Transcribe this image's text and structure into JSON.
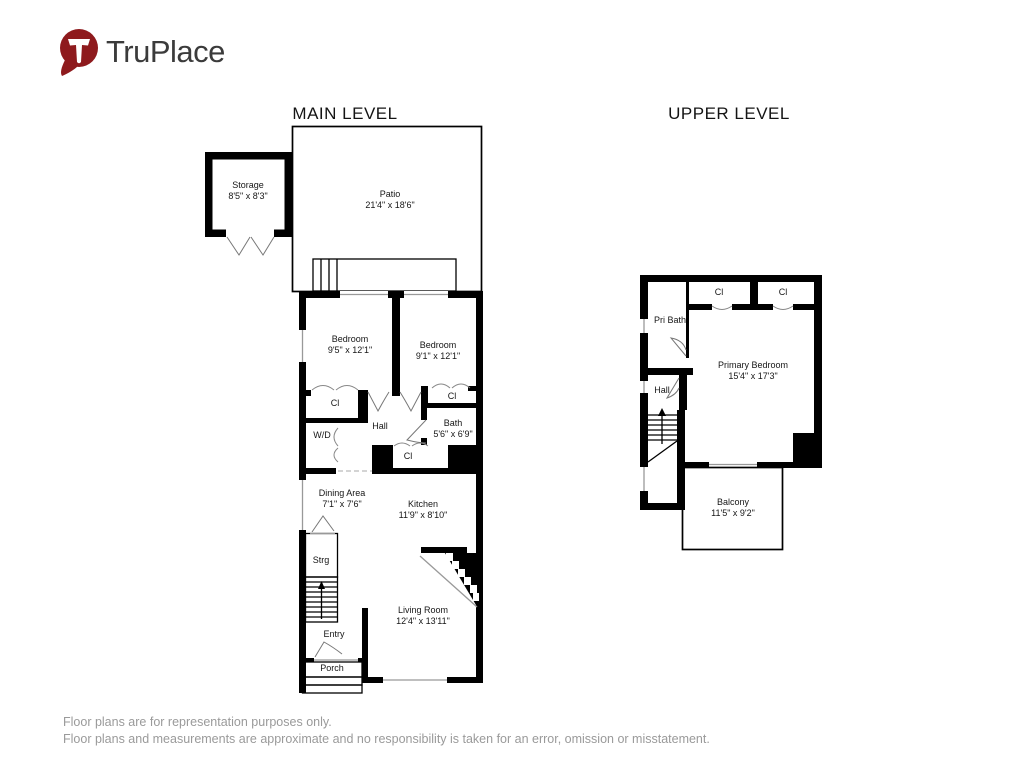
{
  "logo": {
    "brand": "TruPlace"
  },
  "titles": {
    "main": "MAIN LEVEL",
    "upper": "UPPER LEVEL"
  },
  "main_level": {
    "storage": {
      "name": "Storage",
      "dims": "8'5\" x 8'3\""
    },
    "patio": {
      "name": "Patio",
      "dims": "21'4\" x 18'6\""
    },
    "bedroom_left": {
      "name": "Bedroom",
      "dims": "9'5\" x 12'1\""
    },
    "bedroom_right": {
      "name": "Bedroom",
      "dims": "9'1\" x 12'1\""
    },
    "closet_left": {
      "name": "Cl"
    },
    "closet_right": {
      "name": "Cl"
    },
    "closet_hall": {
      "name": "Cl"
    },
    "washer_dryer": {
      "name": "W/D"
    },
    "hall": {
      "name": "Hall"
    },
    "bath": {
      "name": "Bath",
      "dims": "5'6\" x 6'9\""
    },
    "dining": {
      "name": "Dining Area",
      "dims": "7'1\" x 7'6\""
    },
    "kitchen": {
      "name": "Kitchen",
      "dims": "11'9\" x 8'10\""
    },
    "strg": {
      "name": "Strg"
    },
    "entry": {
      "name": "Entry"
    },
    "living": {
      "name": "Living Room",
      "dims": "12'4\" x 13'11\""
    },
    "porch": {
      "name": "Porch"
    }
  },
  "upper_level": {
    "pri_bath": {
      "name": "Pri Bath"
    },
    "closet_left": {
      "name": "Cl"
    },
    "closet_right": {
      "name": "Cl"
    },
    "primary_bedroom": {
      "name": "Primary Bedroom",
      "dims": "15'4\" x 17'3\""
    },
    "hall": {
      "name": "Hall"
    },
    "balcony": {
      "name": "Balcony",
      "dims": "11'5\" x 9'2\""
    }
  },
  "footer": {
    "line1": "Floor plans are for representation purposes only.",
    "line2": "Floor plans and measurements are approximate and no responsibility is taken for an error, omission or misstatement."
  },
  "colors": {
    "brand_red": "#8e1a1d",
    "wall_black": "#000000",
    "window_gray": "#999999",
    "footer_gray": "#9a9a9a"
  }
}
